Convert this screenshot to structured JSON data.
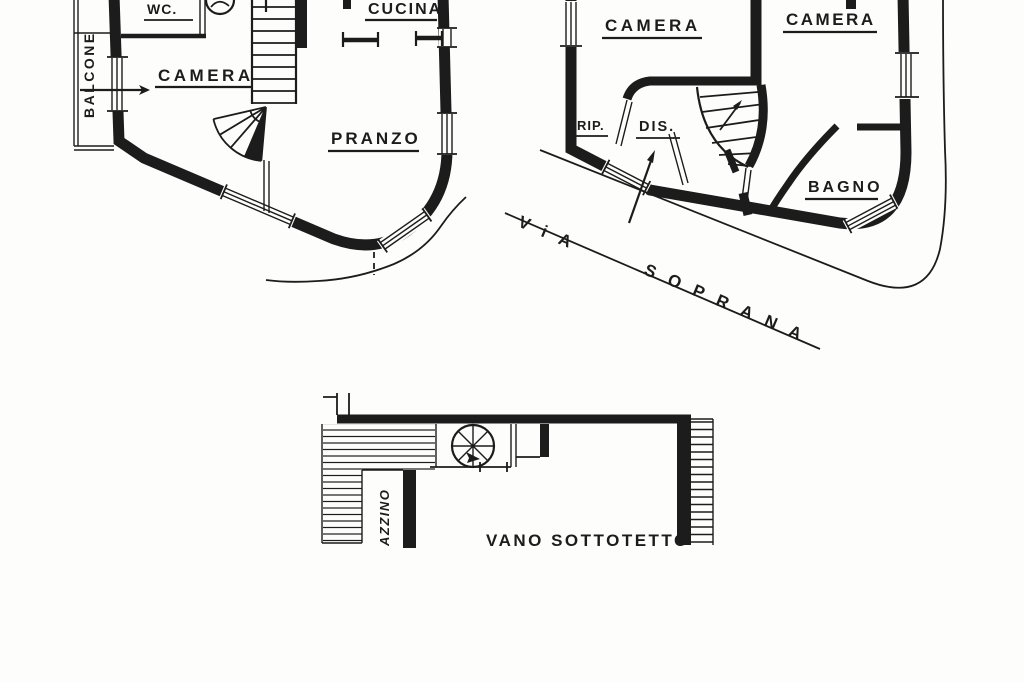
{
  "palette": {
    "ink": "#1c1c1c",
    "paper": "#fdfdfc"
  },
  "floor_plan_1": {
    "balcone": "BALCONE",
    "wc": "WC.",
    "camera": "CAMERA",
    "cucina": "CUCINA",
    "pranzo": "PRANZO"
  },
  "floor_plan_2": {
    "camera_left": "CAMERA",
    "camera_right": "CAMERA",
    "rip": "RIP.",
    "dis": "DIS.",
    "bagno": "BAGNO"
  },
  "street": {
    "via": "ViA",
    "soprana": "SOPRANA"
  },
  "attic_plan": {
    "vano_sottotetto": "VANO SOTTOTETTO",
    "terrazzino_partial": "AZZINO"
  }
}
